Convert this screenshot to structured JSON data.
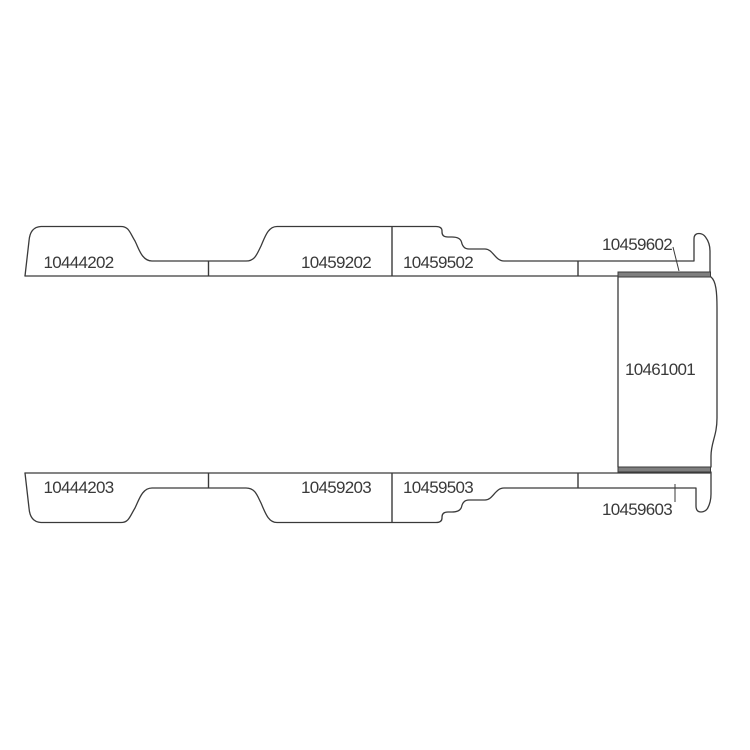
{
  "diagram": {
    "title": "van-floor-trim-parts-diagram",
    "background_color": "#ffffff",
    "line_color": "#3a3a3a",
    "band_fill_color": "#7f7f7f",
    "text_color": "#3a3a3a",
    "parts": [
      {
        "number": "10444202",
        "region": "top-strip-left-section"
      },
      {
        "number": "10459202",
        "region": "top-strip-middle-section"
      },
      {
        "number": "10459502",
        "region": "top-strip-right-section"
      },
      {
        "number": "10459602",
        "region": "top-sill-band"
      },
      {
        "number": "10461001",
        "region": "rear-panel"
      },
      {
        "number": "10444203",
        "region": "bottom-strip-left-section"
      },
      {
        "number": "10459203",
        "region": "bottom-strip-middle-section"
      },
      {
        "number": "10459503",
        "region": "bottom-strip-right-section"
      },
      {
        "number": "10459603",
        "region": "bottom-sill-band"
      }
    ]
  }
}
